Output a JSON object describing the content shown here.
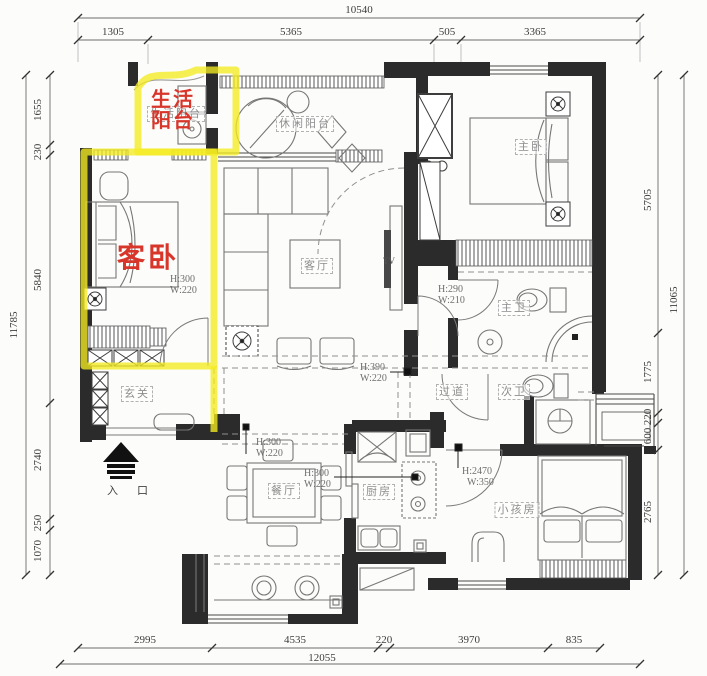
{
  "plan": {
    "dimensions": {
      "top": {
        "total": "10540",
        "segments": [
          "1305",
          "5365",
          "505",
          "3365"
        ]
      },
      "left": {
        "total": "11785",
        "segments": [
          "1655",
          "230",
          "5840",
          "2740",
          "250",
          "1070"
        ]
      },
      "right": {
        "total": "11065",
        "segments": [
          "5705",
          "1775",
          "220",
          "600",
          "2765"
        ]
      },
      "bottom": {
        "total": "12055",
        "segments": [
          "2995",
          "4535",
          "220",
          "3970",
          "835"
        ]
      }
    },
    "rooms": {
      "living_balcony": "生活阳台",
      "leisure_balcony": "休闲阳台",
      "master_bedroom": "主卧",
      "guest_bedroom": "客卧",
      "living_room": "客厅",
      "entry": "玄关",
      "dining_room": "餐厅",
      "kitchen": "厨房",
      "hallway": "过道",
      "master_bath": "主卫",
      "second_bath": "次卫",
      "kids_room": "小孩房"
    },
    "highlights": {
      "highlight_color": "#f3eb21",
      "label_color": "#d8362b",
      "living_balcony": {
        "line1": "生活",
        "line2": "阳台"
      },
      "guest_bedroom": "客卧"
    },
    "annotations": {
      "guest_bedroom": {
        "h": "H:300",
        "w": "W:220"
      },
      "living_room": {
        "h": "H:390",
        "w": "W:220"
      },
      "master_bath": {
        "h": "H:290",
        "w": "W:210"
      },
      "dining_top": {
        "h": "H:300",
        "w": "W:220"
      },
      "dining_mid": {
        "h": "H:300",
        "w": "W:220"
      },
      "kids_room": {
        "h": "H:2470",
        "w": "W:350"
      }
    },
    "labels": {
      "entrance": "入 口",
      "tv": "TV"
    }
  }
}
